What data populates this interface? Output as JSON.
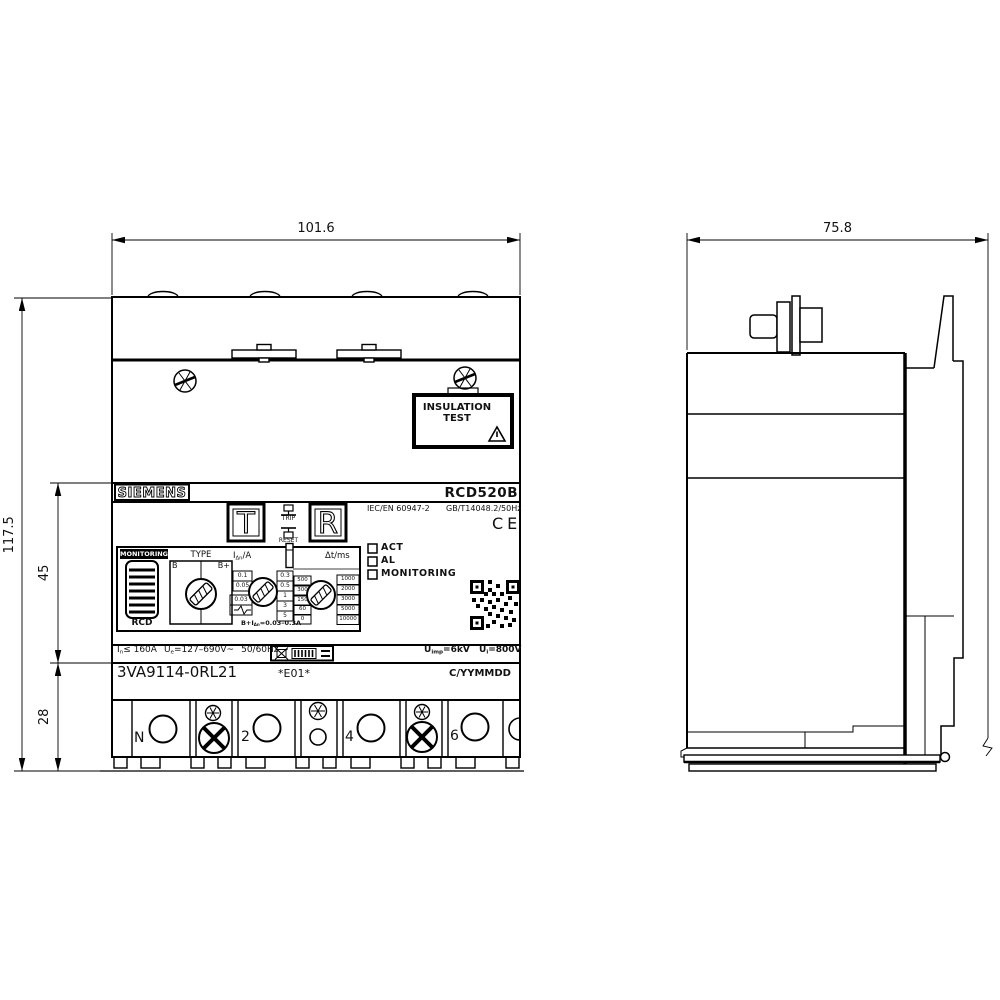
{
  "front": {
    "dim_width": "101.6",
    "dim_height_total": "117.5",
    "dim_height_mid": "45",
    "dim_height_bottom": "28",
    "brand": "SIEMENS",
    "model": "RCD520B",
    "insulation_box": {
      "line1": "INSULATION",
      "line2": "TEST"
    },
    "test_button": "T",
    "reset_button": "R",
    "trip_label": "TRIP",
    "reset_label": "RESET",
    "std_iec": "IEC/EN 60947-2",
    "std_gb": "GB/T14048.2/50Hz",
    "ce": "CE",
    "panel": {
      "monitoring": "MONITORING",
      "rcd": "RCD",
      "type_label": "TYPE",
      "type_b": "B",
      "type_bplus": "B+",
      "idn_base": "I",
      "idn_sub": "Δn",
      "idn_unit": "/A",
      "idn_left": [
        "0.1",
        "0.05",
        "0.03"
      ],
      "idn_right": [
        "0.3",
        "0.5",
        "1",
        "3",
        "5"
      ],
      "dt_label": "Δt/ms",
      "dt_left": [
        "500",
        "300",
        "150",
        "60",
        "0"
      ],
      "dt_right": [
        "1000",
        "2000",
        "3000",
        "5000",
        "10000"
      ],
      "note_pre": "B+I",
      "note_sub": "Δn",
      "note_post": "=0.03–0.3A"
    },
    "leds": [
      "ACT",
      "AL",
      "MONITORING"
    ],
    "ratings": {
      "current_base": "I",
      "current_sub": "n",
      "current_rest": "≤ 160A",
      "voltage_base": "U",
      "voltage_sub": "e",
      "voltage_rest": "=127–690V~",
      "freq": "50/60Hz",
      "uimp_base": "U",
      "uimp_sub": "imp",
      "uimp_rest": "=6kV",
      "ui_base": "U",
      "ui_sub": "i",
      "ui_rest": "=800V"
    },
    "mlfb": "3VA9114-0RL21",
    "version": "*E01*",
    "datecode": "C/YYMMDD",
    "terminals": [
      "N",
      "2",
      "4",
      "6"
    ]
  },
  "side": {
    "dim_width": "75.8"
  }
}
